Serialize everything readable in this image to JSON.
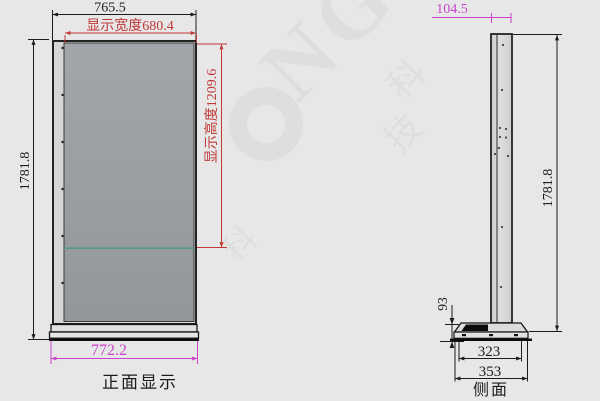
{
  "front_view": {
    "caption": "正面显示",
    "dim_overall_width": "765.5",
    "dim_display_width": "显示宽度680.4",
    "dim_overall_height": "1781.8",
    "dim_display_height": "显示高度1209.6",
    "dim_base_width": "772.2"
  },
  "side_view": {
    "caption": "侧面",
    "dim_depth": "104.5",
    "dim_overall_height": "1781.8",
    "dim_base_height": "93",
    "dim_base_inner_width": "323",
    "dim_base_outer_width": "353"
  },
  "watermark": {
    "letters": "NG",
    "char_a": "科",
    "char_b": "技",
    "char_c": "科"
  },
  "colors": {
    "background": "#e7e7e7",
    "dim_black": "#1c1c1c",
    "dim_red": "#c03a3a",
    "dim_magenta": "#cb42cb",
    "screen_gray": "#9a9da2",
    "display_line_green": "#579a84",
    "panel_light": "#d6d6d6"
  }
}
